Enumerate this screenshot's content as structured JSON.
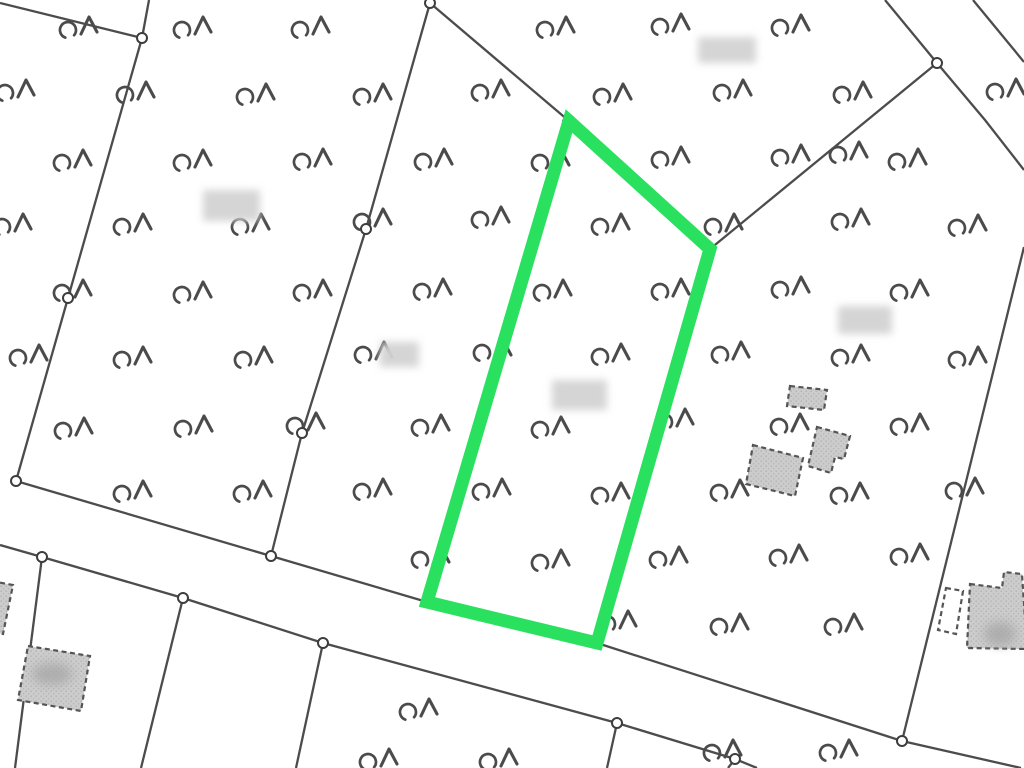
{
  "map": {
    "kind": "cadastral-parcel-map",
    "canvas": {
      "width": 1024,
      "height": 768,
      "background": "#ffffff"
    },
    "colors": {
      "boundary": "#3d3d3d",
      "node_fill": "#ffffff",
      "tree": "#4b4b4b",
      "building_fill": "#cccccc",
      "building_dot": "#b2b2b2",
      "building_stroke": "#555555",
      "blur_patch": "#d3d3d3",
      "smudge": "#a8a8a8",
      "highlight": "#2ae15f"
    },
    "highlight_parcel": {
      "points": "569,121 710,249 597,643 427,602",
      "stroke_width": 13
    },
    "boundaries": [
      {
        "points": "0,3 142,38"
      },
      {
        "points": "149,0 142,38"
      },
      {
        "points": "142,38 68,298 16,481"
      },
      {
        "points": "430,3 366,229 302,433 271,556"
      },
      {
        "points": "430,3 569,121"
      },
      {
        "points": "569,121 710,249"
      },
      {
        "points": "710,249 597,643"
      },
      {
        "points": "710,249 937,63"
      },
      {
        "points": "885,0 937,63"
      },
      {
        "points": "937,63 985,120 1024,170"
      },
      {
        "points": "973,0 1024,62"
      },
      {
        "points": "1024,247 902,741"
      },
      {
        "points": "16,481 271,556 427,602 597,643 902,741 1021,768"
      },
      {
        "points": "0,545 42,557 183,598 323,643 617,723 735,759 757,768"
      },
      {
        "points": "42,557 15,768"
      },
      {
        "points": "183,598 141,768"
      },
      {
        "points": "323,643 296,768"
      },
      {
        "points": "617,723 607,768"
      },
      {
        "points": "735,759 728,768"
      }
    ],
    "nodes": [
      [
        142,
        38
      ],
      [
        430,
        3
      ],
      [
        68,
        298
      ],
      [
        366,
        229
      ],
      [
        302,
        433
      ],
      [
        16,
        481
      ],
      [
        271,
        556
      ],
      [
        42,
        557
      ],
      [
        183,
        598
      ],
      [
        323,
        643
      ],
      [
        617,
        723
      ],
      [
        735,
        759
      ],
      [
        937,
        63
      ],
      [
        902,
        741
      ],
      [
        568,
        122
      ]
    ],
    "trees": [
      [
        68,
        30
      ],
      [
        182,
        30
      ],
      [
        300,
        30
      ],
      [
        545,
        30
      ],
      [
        660,
        27
      ],
      [
        780,
        28
      ],
      [
        5,
        93
      ],
      [
        125,
        95
      ],
      [
        245,
        97
      ],
      [
        362,
        97
      ],
      [
        480,
        93
      ],
      [
        602,
        97
      ],
      [
        722,
        93
      ],
      [
        842,
        95
      ],
      [
        995,
        92
      ],
      [
        62,
        163
      ],
      [
        182,
        163
      ],
      [
        302,
        162
      ],
      [
        423,
        162
      ],
      [
        540,
        163
      ],
      [
        660,
        160
      ],
      [
        780,
        158
      ],
      [
        838,
        155
      ],
      [
        897,
        162
      ],
      [
        2,
        227
      ],
      [
        122,
        227
      ],
      [
        240,
        227
      ],
      [
        362,
        222
      ],
      [
        480,
        220
      ],
      [
        600,
        227
      ],
      [
        713,
        227
      ],
      [
        840,
        222
      ],
      [
        957,
        228
      ],
      [
        62,
        293
      ],
      [
        182,
        295
      ],
      [
        302,
        293
      ],
      [
        422,
        292
      ],
      [
        542,
        293
      ],
      [
        660,
        292
      ],
      [
        780,
        290
      ],
      [
        899,
        293
      ],
      [
        18,
        358
      ],
      [
        122,
        360
      ],
      [
        243,
        360
      ],
      [
        363,
        355
      ],
      [
        482,
        353
      ],
      [
        600,
        357
      ],
      [
        720,
        355
      ],
      [
        840,
        358
      ],
      [
        957,
        360
      ],
      [
        63,
        431
      ],
      [
        183,
        429
      ],
      [
        295,
        426
      ],
      [
        420,
        428
      ],
      [
        540,
        430
      ],
      [
        664,
        422
      ],
      [
        779,
        427
      ],
      [
        899,
        427
      ],
      [
        122,
        494
      ],
      [
        242,
        494
      ],
      [
        362,
        492
      ],
      [
        481,
        492
      ],
      [
        600,
        496
      ],
      [
        719,
        493
      ],
      [
        839,
        496
      ],
      [
        954,
        491
      ],
      [
        420,
        560
      ],
      [
        540,
        563
      ],
      [
        658,
        560
      ],
      [
        778,
        558
      ],
      [
        899,
        557
      ],
      [
        607,
        624
      ],
      [
        719,
        627
      ],
      [
        833,
        627
      ],
      [
        408,
        712
      ],
      [
        368,
        762
      ],
      [
        488,
        762
      ],
      [
        712,
        753
      ],
      [
        828,
        753
      ]
    ],
    "buildings": [
      {
        "points": "-25,578 13,585 3,634 -30,627",
        "filled": true
      },
      {
        "points": "28,646 90,656 81,711 18,700",
        "filled": true
      },
      {
        "points": "790,386 827,390 824,410 787,406",
        "filled": true
      },
      {
        "points": "817,427 850,436 844,459 835,457 831,473 808,466",
        "filled": true
      },
      {
        "points": "753,445 803,458 795,496 746,484",
        "filled": true
      },
      {
        "points": "946,588 963,591 956,634 938,630",
        "filled": false
      },
      {
        "points": "970,584 1002,588 1004,572 1022,574 1027,649 967,648",
        "filled": true
      }
    ],
    "smudges": [
      {
        "cx": 52,
        "cy": 674,
        "rx": 20,
        "ry": 11
      },
      {
        "cx": 1000,
        "cy": 634,
        "rx": 16,
        "ry": 12
      }
    ],
    "blur_labels": [
      {
        "x": 203,
        "y": 190,
        "w": 57,
        "h": 31
      },
      {
        "x": 698,
        "y": 37,
        "w": 58,
        "h": 26
      },
      {
        "x": 838,
        "y": 306,
        "w": 54,
        "h": 28
      },
      {
        "x": 552,
        "y": 380,
        "w": 55,
        "h": 30
      },
      {
        "x": 380,
        "y": 342,
        "w": 39,
        "h": 25
      }
    ]
  }
}
